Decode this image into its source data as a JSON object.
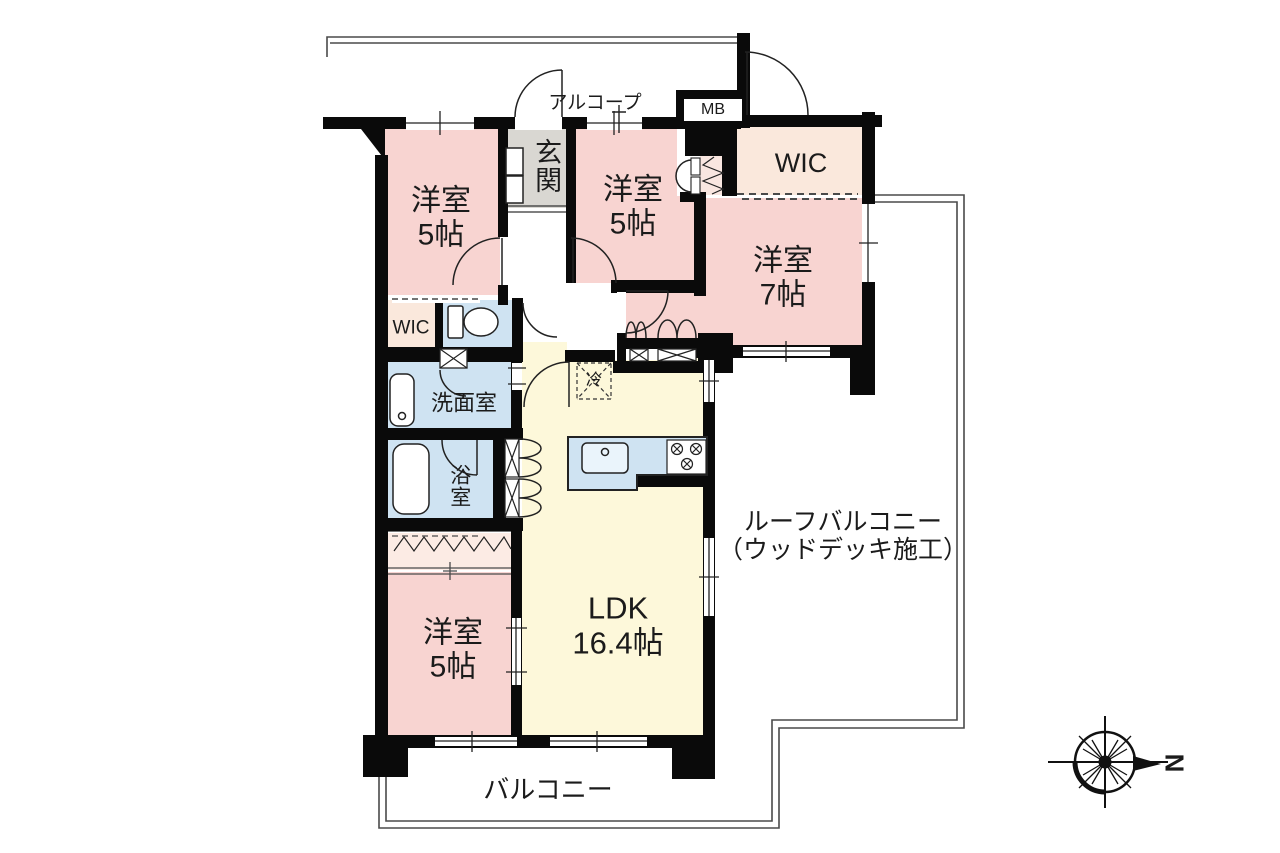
{
  "rooms": {
    "bedroom_a": {
      "label": "洋室",
      "size": "5帖"
    },
    "bedroom_b": {
      "label": "洋室",
      "size": "5帖"
    },
    "bedroom_c": {
      "label": "洋室",
      "size": "7帖"
    },
    "bedroom_d": {
      "label": "洋室",
      "size": "5帖"
    },
    "ldk": {
      "label": "LDK",
      "size": "16.4帖"
    },
    "wic_large": {
      "label": "WIC"
    },
    "wic_small": {
      "label": "WIC"
    },
    "entrance": {
      "label": "玄関"
    },
    "washroom": {
      "label": "洗面室"
    },
    "bathroom": {
      "label": "浴室"
    }
  },
  "outdoor": {
    "balcony": {
      "label": "バルコニー"
    },
    "roof_balcony": {
      "label": "ルーフバルコニー",
      "sublabel": "（ウッドデッキ施工）"
    },
    "alcove": {
      "label": "アルコープ"
    }
  },
  "annotations": {
    "meter_box": {
      "label": "MB"
    },
    "refrigerator": {
      "label": "冷"
    },
    "compass_north": {
      "label": "N"
    }
  },
  "colors": {
    "bedroom": "#f8d4d1",
    "closet": "#fbeae3",
    "storage": "#fae8dc",
    "wet_area": "#cfe3f2",
    "ldk": "#fdf8da",
    "entrance_floor": "#d9d7d2",
    "wall": "#0a0a0a",
    "outline": "#555555"
  }
}
